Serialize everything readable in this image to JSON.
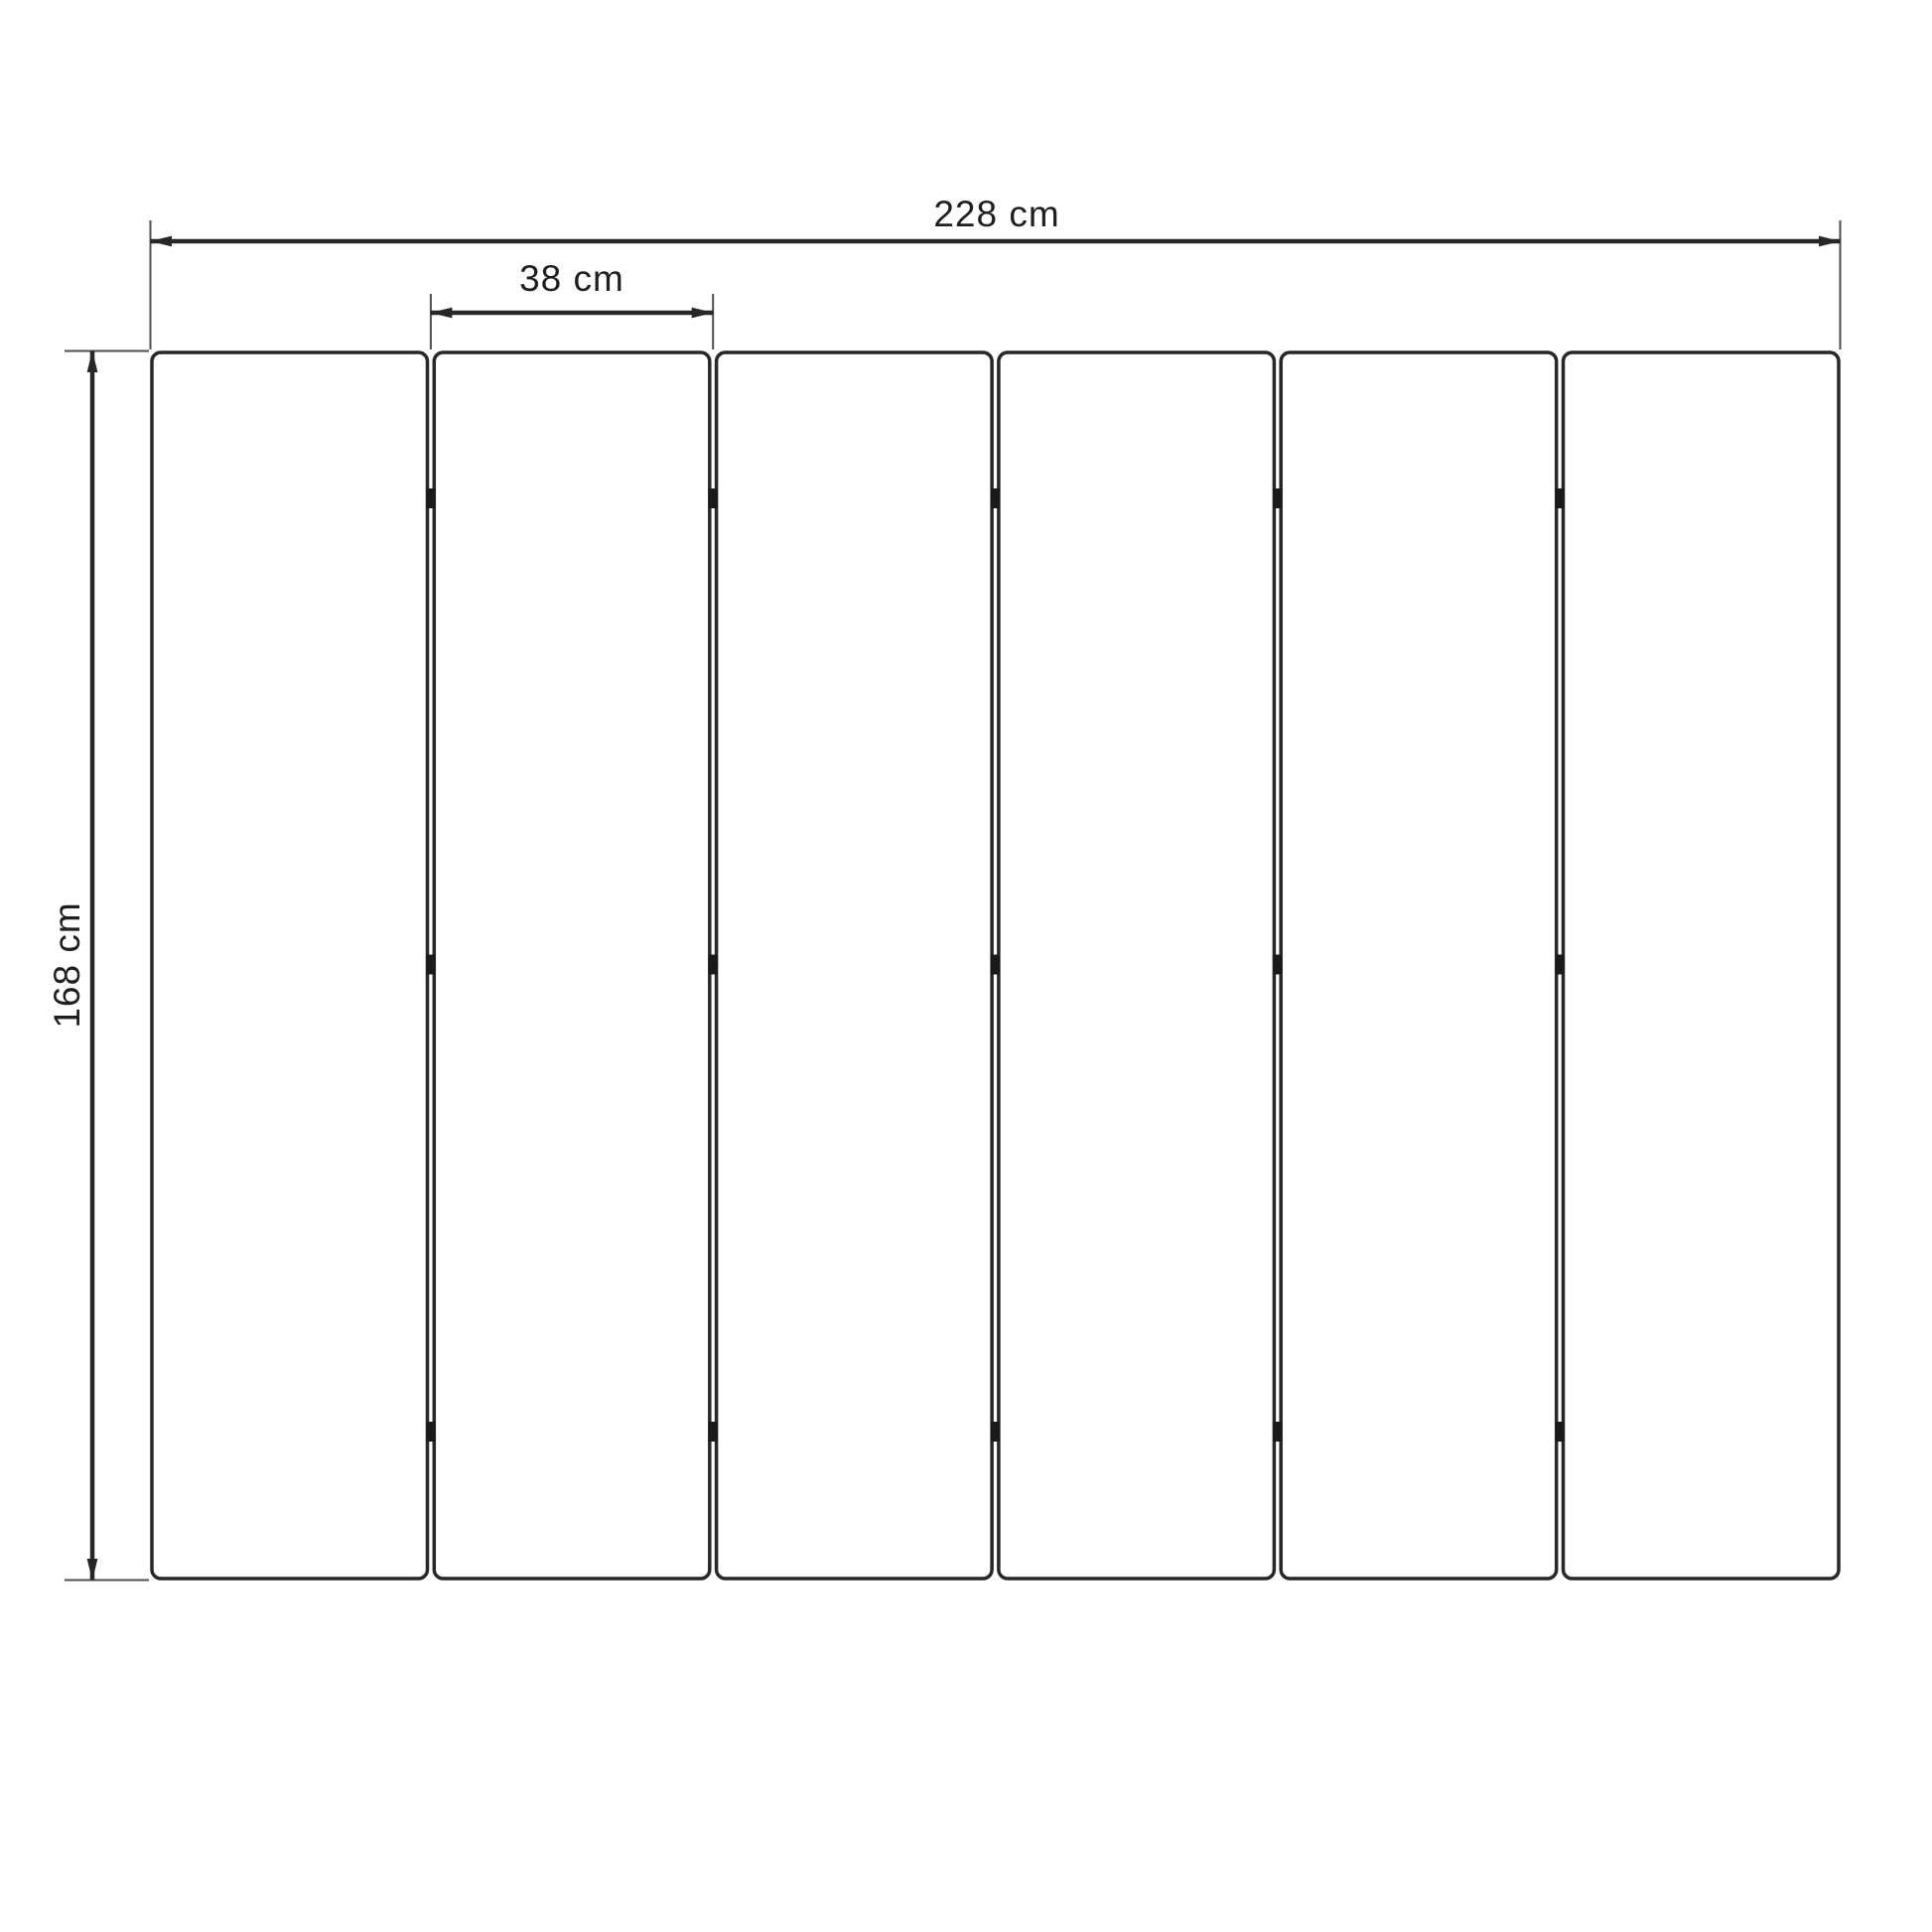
{
  "diagram": {
    "kind": "technical-dimension-drawing",
    "panel_count": 6,
    "hinge_rows": 3,
    "labels": {
      "total_width": "228 cm",
      "panel_width": "38 cm",
      "height": "168 cm"
    },
    "colors": {
      "background": "#ffffff",
      "panel_fill": "#ffffff",
      "line": "#272727",
      "extension_line": "#4f4f4f",
      "hinge": "#1a1a1a",
      "text": "#1f1f1f"
    }
  }
}
